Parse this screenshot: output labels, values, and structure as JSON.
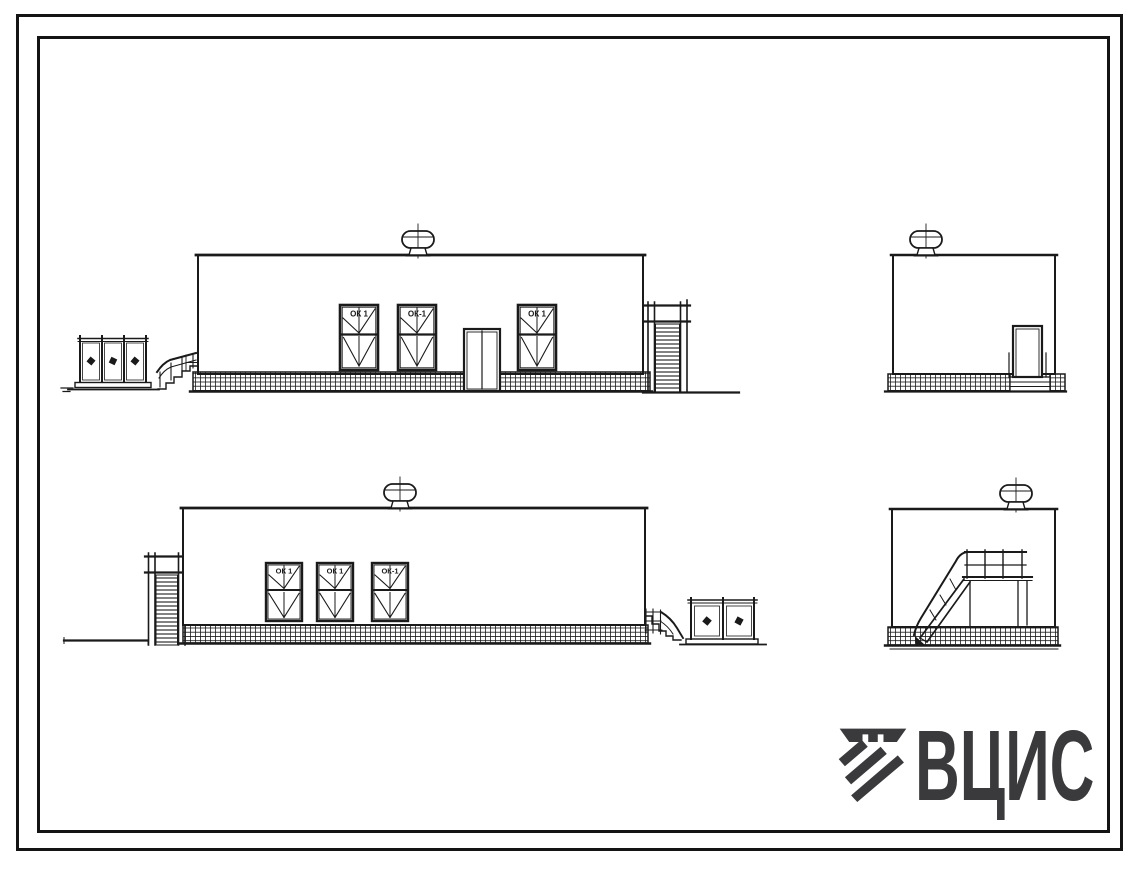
{
  "colors": {
    "paper": "#ffffff",
    "ink": "#1a1a1a",
    "logo": "#3a3a3c"
  },
  "front_elevation": {
    "window_labels": [
      "ОК 1",
      "ОК-1",
      "ОК 1"
    ]
  },
  "rear_elevation": {
    "window_labels": [
      "ОК 1",
      "ОК 1",
      "ОК-1"
    ]
  },
  "logo": {
    "text": "ВЦИС"
  }
}
